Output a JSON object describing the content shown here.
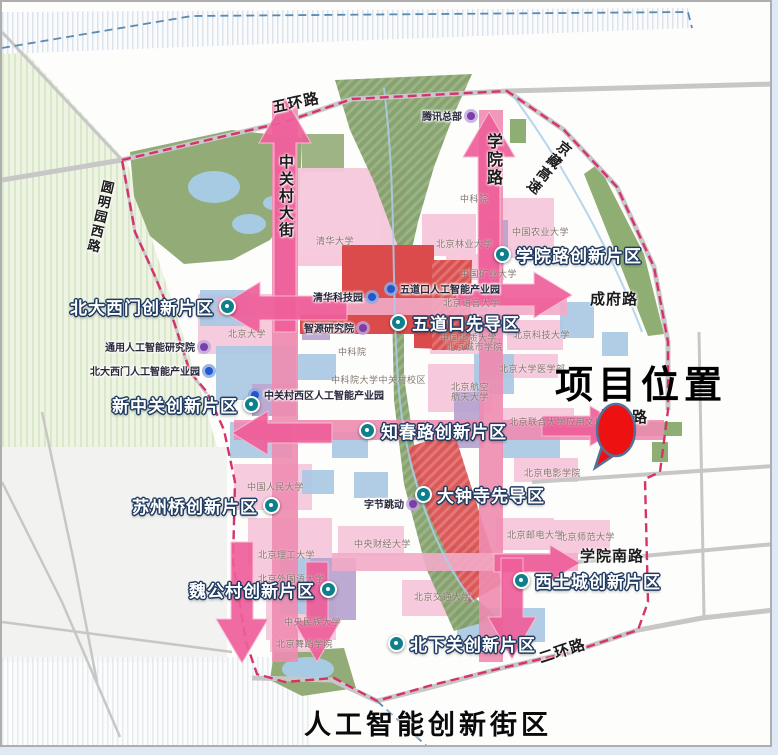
{
  "map": {
    "district_title": "人工智能创新街区",
    "project_label": "项目位置"
  },
  "colors": {
    "boundary": "#d6336c",
    "arrow_pink": "#ef5f9a",
    "road_band_pink": "#ef8cb1",
    "road_band_light": "#f3abc7",
    "zone_dot_teal": "#0e7f8c",
    "poi_blue": "#2257cf",
    "poi_purple": "#7a3fa8",
    "marker_red": "#ee1111",
    "park_green": "#93ac77",
    "corridor_green": "#7d9c64",
    "zone_red": "#dc4b4b",
    "campus_pink": "#f6c8db",
    "block_blue": "#abc8e4",
    "block_purple": "#b7a4cf",
    "water_blue": "#a6cbe3"
  },
  "zones": [
    {
      "label": "北大西门创新片区",
      "x": 68,
      "y": 292,
      "dot": "right"
    },
    {
      "label": "学院路创新片区",
      "x": 492,
      "y": 240,
      "dot": "left"
    },
    {
      "label": "五道口先导区",
      "x": 388,
      "y": 308,
      "dot": "left"
    },
    {
      "label": "新中关创新片区",
      "x": 110,
      "y": 390,
      "dot": "right"
    },
    {
      "label": "知春路创新片区",
      "x": 357,
      "y": 416,
      "dot": "left"
    },
    {
      "label": "苏州桥创新片区",
      "x": 130,
      "y": 491,
      "dot": "right"
    },
    {
      "label": "大钟寺先导区",
      "x": 413,
      "y": 480,
      "dot": "left"
    },
    {
      "label": "魏公村创新片区",
      "x": 187,
      "y": 575,
      "dot": "right"
    },
    {
      "label": "西土城创新片区",
      "x": 511,
      "y": 566,
      "dot": "left"
    },
    {
      "label": "北下关创新片区",
      "x": 386,
      "y": 629,
      "dot": "left"
    }
  ],
  "pois": [
    {
      "label": "腾讯总部",
      "x": 420,
      "y": 106,
      "color": "purple",
      "dot": "right"
    },
    {
      "label": "清华科技园",
      "x": 311,
      "y": 287,
      "color": "blue",
      "dot": "right"
    },
    {
      "label": "五道口人工智能产业园",
      "x": 385,
      "y": 279,
      "color": "blue",
      "dot": "left"
    },
    {
      "label": "智源研究院",
      "x": 302,
      "y": 318,
      "color": "purple",
      "dot": "right"
    },
    {
      "label": "通用人工智能研究院",
      "x": 103,
      "y": 337,
      "color": "purple",
      "dot": "right"
    },
    {
      "label": "北大西门人工智能产业园",
      "x": 88,
      "y": 361,
      "color": "blue",
      "dot": "right"
    },
    {
      "label": "中关村西区人工智能产业园",
      "x": 249,
      "y": 385,
      "color": "blue",
      "dot": "left"
    },
    {
      "label": "字节跳动",
      "x": 362,
      "y": 494,
      "color": "purple",
      "dot": "right"
    }
  ],
  "campuses": [
    {
      "label": "清华大学",
      "x": 314,
      "y": 232
    },
    {
      "label": "北京大学",
      "x": 226,
      "y": 325
    },
    {
      "label": "北京林业大学",
      "x": 434,
      "y": 235
    },
    {
      "label": "中国农业大学",
      "x": 510,
      "y": 223
    },
    {
      "label": "中国矿业大学",
      "x": 458,
      "y": 265
    },
    {
      "label": "北京语言大学",
      "x": 441,
      "y": 294
    },
    {
      "label": "中国地质大学",
      "x": 438,
      "y": 329
    },
    {
      "label": "北京城市学院",
      "x": 444,
      "y": 338
    },
    {
      "label": "北京科技大学",
      "x": 511,
      "y": 326
    },
    {
      "label": "北京大学医学部",
      "x": 497,
      "y": 360
    },
    {
      "label": "北京航空",
      "x": 449,
      "y": 378
    },
    {
      "label": "航天大学",
      "x": 449,
      "y": 388
    },
    {
      "label": "北京联合大学应用文理学院",
      "x": 507,
      "y": 413
    },
    {
      "label": "北京电影学院",
      "x": 522,
      "y": 464
    },
    {
      "label": "中科院",
      "x": 458,
      "y": 190
    },
    {
      "label": "中科院",
      "x": 336,
      "y": 343
    },
    {
      "label": "中科院大学中关村校区",
      "x": 329,
      "y": 371
    },
    {
      "label": "中国人民大学",
      "x": 245,
      "y": 478
    },
    {
      "label": "中央财经大学",
      "x": 352,
      "y": 535
    },
    {
      "label": "北京理工大学",
      "x": 256,
      "y": 546
    },
    {
      "label": "北京外国语大学",
      "x": 256,
      "y": 570
    },
    {
      "label": "中央民族大学",
      "x": 282,
      "y": 613
    },
    {
      "label": "北京舞蹈学院",
      "x": 274,
      "y": 635
    },
    {
      "label": "北京交通大学",
      "x": 412,
      "y": 588
    },
    {
      "label": "北京邮电大学",
      "x": 505,
      "y": 526
    },
    {
      "label": "北京师范大学",
      "x": 556,
      "y": 528
    }
  ],
  "roads": [
    {
      "label": "五环路",
      "x": 268,
      "y": 95,
      "size": 15,
      "rotate": -12
    },
    {
      "label": "中关村大街",
      "x": 274,
      "y": 152,
      "size": 15,
      "vertical": true
    },
    {
      "label": "学院路",
      "x": 479,
      "y": 131,
      "size": 16,
      "vertical": true
    },
    {
      "label": "京藏高速",
      "x": 558,
      "y": 134,
      "size": 14,
      "vertical": true,
      "rotate": 38
    },
    {
      "label": "圆明园西路",
      "x": 96,
      "y": 176,
      "size": 13,
      "vertical": true,
      "rotate": 13
    },
    {
      "label": "成府路",
      "x": 588,
      "y": 286,
      "size": 15
    },
    {
      "label": "知春路",
      "x": 598,
      "y": 404,
      "size": 15
    },
    {
      "label": "学院南路",
      "x": 578,
      "y": 543,
      "size": 15
    },
    {
      "label": "二环路",
      "x": 534,
      "y": 646,
      "size": 15,
      "rotate": -18
    }
  ]
}
